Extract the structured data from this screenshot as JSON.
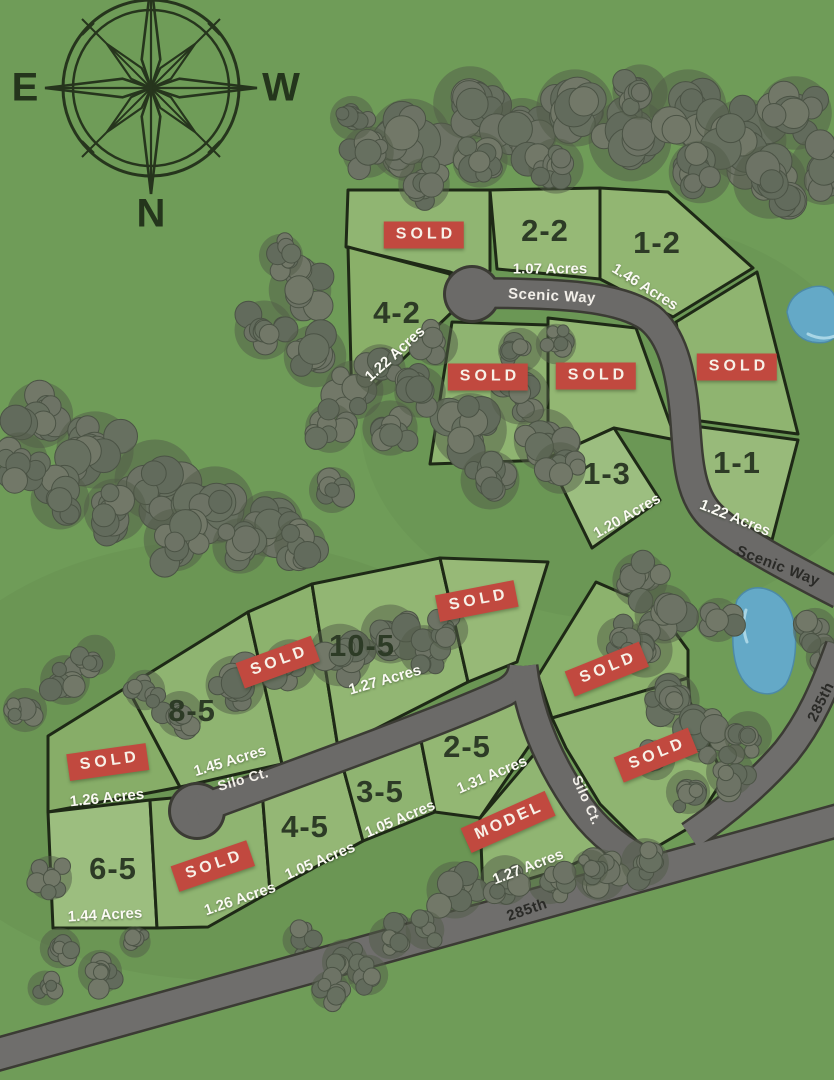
{
  "compass": {
    "east": "E",
    "west": "W",
    "north": "N"
  },
  "badges": {
    "sold_label": "SOLD",
    "model_label": "MODEL"
  },
  "roads": [
    {
      "name": "Scenic Way"
    },
    {
      "name": "Silo Ct."
    },
    {
      "name": "285th"
    }
  ],
  "road_labels": [
    {
      "text": "Scenic Way"
    },
    {
      "text": "Scenic Way"
    },
    {
      "text": "Silo Ct."
    },
    {
      "text": "Silo Ct."
    },
    {
      "text": "285th"
    },
    {
      "text": "285th"
    }
  ],
  "colors": {
    "background_green": "#6f9c58",
    "lot_green": "#8fb471",
    "sold_badge_red": "#c1493f",
    "road_gray": "#6b6a68",
    "pond_blue": "#64a9c7",
    "boundary_dark": "#1e2916"
  },
  "clusters": {
    "upper": {
      "lots": [
        {
          "id": "u-sold-1",
          "status": "sold",
          "badge": "SOLD"
        },
        {
          "id": "2-2",
          "status": "available",
          "number": "2-2",
          "acres": "1.07 Acres"
        },
        {
          "id": "1-2",
          "status": "available",
          "number": "1-2",
          "acres": "1.46 Acres"
        },
        {
          "id": "4-2",
          "status": "available",
          "number": "4-2",
          "acres": "1.22 Acres"
        },
        {
          "id": "u-sold-2",
          "status": "sold",
          "badge": "SOLD"
        },
        {
          "id": "u-sold-3",
          "status": "sold",
          "badge": "SOLD"
        },
        {
          "id": "u-sold-4",
          "status": "sold",
          "badge": "SOLD"
        },
        {
          "id": "1-3",
          "status": "available",
          "number": "1-3",
          "acres": "1.20 Acres"
        },
        {
          "id": "1-1",
          "status": "available",
          "number": "1-1",
          "acres": "1.22 Acres"
        }
      ]
    },
    "lower": {
      "lots": [
        {
          "id": "l-sold-top",
          "status": "sold",
          "badge": "SOLD"
        },
        {
          "id": "l-sold-mid",
          "status": "sold",
          "badge": "SOLD"
        },
        {
          "id": "10-5",
          "status": "available",
          "number": "10-5",
          "acres": "1.27 Acres"
        },
        {
          "id": "8-5",
          "status": "available",
          "number": "8-5",
          "acres": "1.45 Acres"
        },
        {
          "id": "l-sold-left",
          "status": "sold",
          "badge": "SOLD",
          "acres": "1.26 Acres"
        },
        {
          "id": "6-5",
          "status": "available",
          "number": "6-5",
          "acres": "1.44 Acres"
        },
        {
          "id": "l-sold-6",
          "status": "sold",
          "badge": "SOLD",
          "acres": "1.26 Acres"
        },
        {
          "id": "4-5",
          "status": "available",
          "number": "4-5",
          "acres": "1.05 Acres"
        },
        {
          "id": "3-5",
          "status": "available",
          "number": "3-5",
          "acres": "1.05 Acres"
        },
        {
          "id": "2-5",
          "status": "available",
          "number": "2-5",
          "acres": "1.31 Acres"
        },
        {
          "id": "l-model",
          "status": "model",
          "badge": "MODEL",
          "acres": "1.27 Acres"
        },
        {
          "id": "l-sold-r1",
          "status": "sold",
          "badge": "SOLD"
        },
        {
          "id": "l-sold-r2",
          "status": "sold",
          "badge": "SOLD"
        }
      ]
    }
  }
}
